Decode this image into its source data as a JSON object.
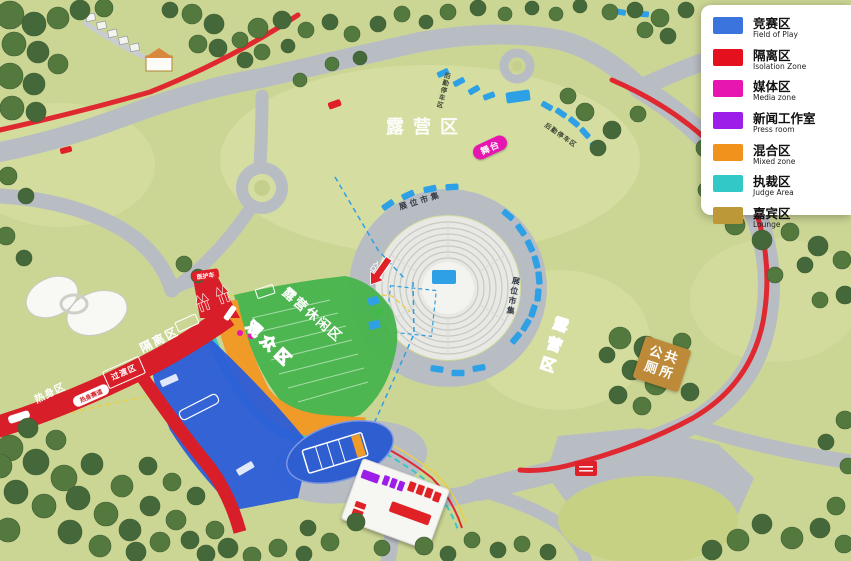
{
  "legend": {
    "items": [
      {
        "zh": "竞赛区",
        "en": "Field of Play",
        "color": "#3B74DD"
      },
      {
        "zh": "隔离区",
        "en": "Isolation Zone",
        "color": "#E5101D"
      },
      {
        "zh": "媒体区",
        "en": "Media zone",
        "color": "#E816B0"
      },
      {
        "zh": "新闻工作室",
        "en": "Press room",
        "color": "#9D1EE8"
      },
      {
        "zh": "混合区",
        "en": "Mixed zone",
        "color": "#F0921B"
      },
      {
        "zh": "执裁区",
        "en": "Judge Area",
        "color": "#32C8C8"
      },
      {
        "zh": "嘉宾区",
        "en": "Lounge",
        "color": "#BD9838"
      }
    ]
  },
  "map": {
    "area_labels": {
      "camping_center": "露营区",
      "camping_right": "露营区",
      "camp_leisure": "露营休闲区",
      "spectator": "观众区",
      "isolation": "隔离区",
      "warmup": "热身区",
      "transition": "过渡区",
      "warmup_track": "热身赛道"
    },
    "poi_labels": {
      "stage": "舞台",
      "public_toilet": "公共\n厕所",
      "booth_market_top": "展位市集",
      "booth_market_right": "展位市集",
      "logistics_parking_top": "后勤停车区",
      "logistics_parking_right": "后勤停车区",
      "medical_vehicle": "医护车",
      "entrance": "入口"
    }
  }
}
